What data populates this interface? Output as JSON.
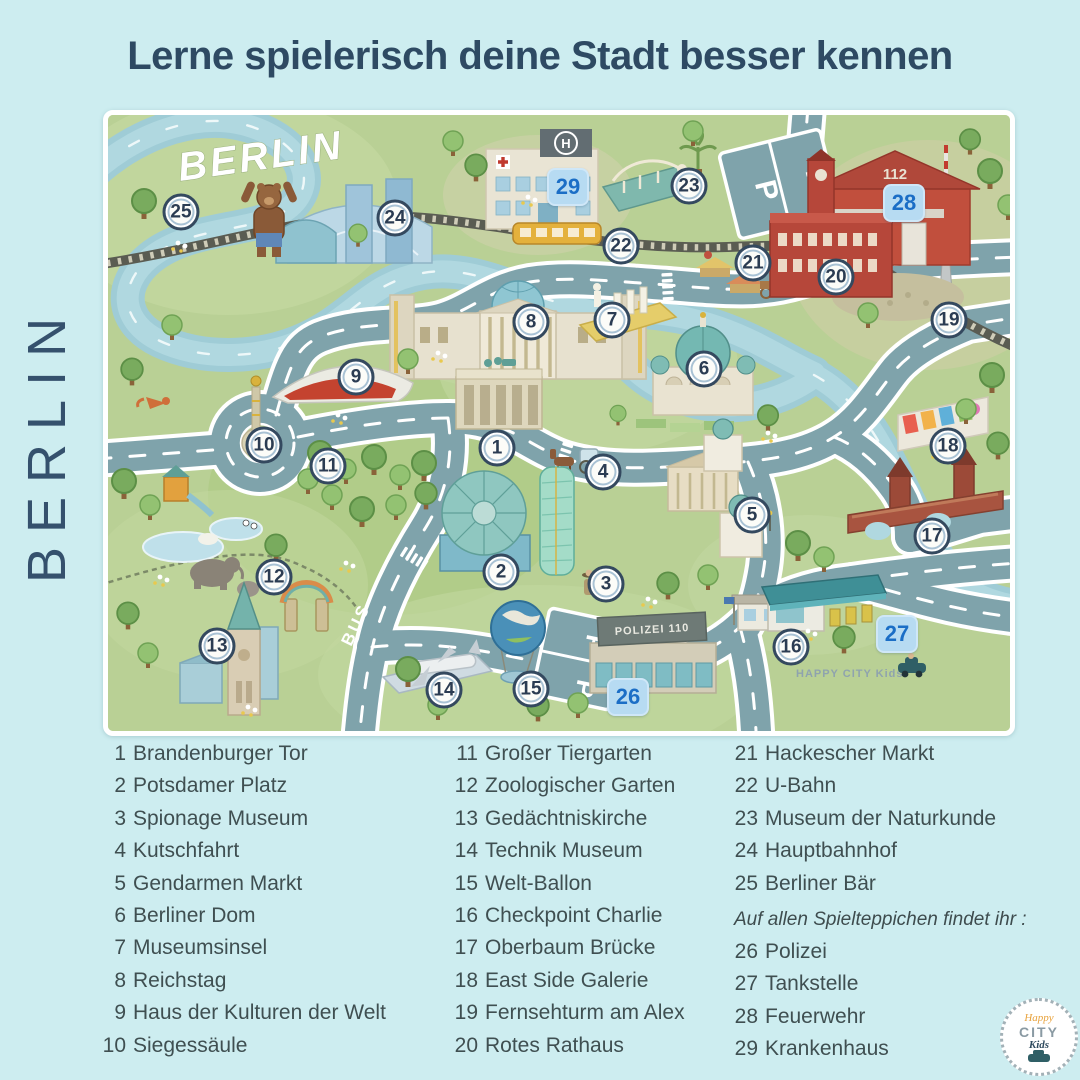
{
  "title": "Lerne spielerisch deine Stadt besser kennen",
  "vertical_label": "BERLIN",
  "map": {
    "label": "BERLIN",
    "bus_lane_label": "BUS",
    "parking_label": "P",
    "hospital_roof_label": "H",
    "fire_station_number": "112",
    "police_roof_label": "POLIZEI 110",
    "watermark": "HAPPY CITY Kids",
    "markers": [
      {
        "n": "1",
        "x": 389,
        "y": 333,
        "type": "circle"
      },
      {
        "n": "2",
        "x": 393,
        "y": 457,
        "type": "circle"
      },
      {
        "n": "3",
        "x": 498,
        "y": 469,
        "type": "circle"
      },
      {
        "n": "4",
        "x": 495,
        "y": 357,
        "type": "circle"
      },
      {
        "n": "5",
        "x": 644,
        "y": 400,
        "type": "circle"
      },
      {
        "n": "6",
        "x": 596,
        "y": 254,
        "type": "circle"
      },
      {
        "n": "7",
        "x": 504,
        "y": 205,
        "type": "circle"
      },
      {
        "n": "8",
        "x": 423,
        "y": 207,
        "type": "circle"
      },
      {
        "n": "9",
        "x": 248,
        "y": 262,
        "type": "circle"
      },
      {
        "n": "10",
        "x": 156,
        "y": 330,
        "type": "circle"
      },
      {
        "n": "11",
        "x": 220,
        "y": 351,
        "type": "circle"
      },
      {
        "n": "12",
        "x": 166,
        "y": 462,
        "type": "circle"
      },
      {
        "n": "13",
        "x": 109,
        "y": 531,
        "type": "circle"
      },
      {
        "n": "14",
        "x": 336,
        "y": 575,
        "type": "circle"
      },
      {
        "n": "15",
        "x": 423,
        "y": 574,
        "type": "circle"
      },
      {
        "n": "16",
        "x": 683,
        "y": 532,
        "type": "circle"
      },
      {
        "n": "17",
        "x": 824,
        "y": 421,
        "type": "circle"
      },
      {
        "n": "18",
        "x": 840,
        "y": 331,
        "type": "circle"
      },
      {
        "n": "19",
        "x": 841,
        "y": 205,
        "type": "circle"
      },
      {
        "n": "20",
        "x": 728,
        "y": 162,
        "type": "circle"
      },
      {
        "n": "21",
        "x": 645,
        "y": 148,
        "type": "circle"
      },
      {
        "n": "22",
        "x": 513,
        "y": 131,
        "type": "circle"
      },
      {
        "n": "23",
        "x": 581,
        "y": 71,
        "type": "circle"
      },
      {
        "n": "24",
        "x": 287,
        "y": 103,
        "type": "circle"
      },
      {
        "n": "25",
        "x": 73,
        "y": 97,
        "type": "circle"
      },
      {
        "n": "26",
        "x": 520,
        "y": 582,
        "type": "badge"
      },
      {
        "n": "27",
        "x": 789,
        "y": 519,
        "type": "badge"
      },
      {
        "n": "28",
        "x": 796,
        "y": 88,
        "type": "badge"
      },
      {
        "n": "29",
        "x": 460,
        "y": 72,
        "type": "badge"
      }
    ]
  },
  "legend": {
    "columns": [
      {
        "items": [
          {
            "n": "1",
            "label": "Brandenburger Tor"
          },
          {
            "n": "2",
            "label": "Potsdamer Platz"
          },
          {
            "n": "3",
            "label": "Spionage Museum"
          },
          {
            "n": "4",
            "label": "Kutschfahrt"
          },
          {
            "n": "5",
            "label": "Gendarmen Markt"
          },
          {
            "n": "6",
            "label": "Berliner Dom"
          },
          {
            "n": "7",
            "label": "Museumsinsel"
          },
          {
            "n": "8",
            "label": "Reichstag"
          },
          {
            "n": "9",
            "label": "Haus der Kulturen der Welt"
          },
          {
            "n": "10",
            "label": "Siegessäule"
          }
        ]
      },
      {
        "items": [
          {
            "n": "11",
            "label": "Großer Tiergarten"
          },
          {
            "n": "12",
            "label": "Zoologischer Garten"
          },
          {
            "n": "13",
            "label": "Gedächtniskirche"
          },
          {
            "n": "14",
            "label": "Technik Museum"
          },
          {
            "n": "15",
            "label": "Welt-Ballon"
          },
          {
            "n": "16",
            "label": "Checkpoint Charlie"
          },
          {
            "n": "17",
            "label": "Oberbaum Brücke"
          },
          {
            "n": "18",
            "label": "East Side Galerie"
          },
          {
            "n": "19",
            "label": "Fernsehturm am Alex"
          },
          {
            "n": "20",
            "label": "Rotes Rathaus"
          }
        ]
      },
      {
        "items": [
          {
            "n": "21",
            "label": "Hackescher Markt"
          },
          {
            "n": "22",
            "label": "U-Bahn"
          },
          {
            "n": "23",
            "label": "Museum der Naturkunde"
          },
          {
            "n": "24",
            "label": "Hauptbahnhof"
          },
          {
            "n": "25",
            "label": "Berliner Bär"
          }
        ],
        "note": "Auf allen Spielteppichen findet ihr :",
        "items_after": [
          {
            "n": "26",
            "label": "Polizei"
          },
          {
            "n": "27",
            "label": "Tankstelle"
          },
          {
            "n": "28",
            "label": "Feuerwehr"
          },
          {
            "n": "29",
            "label": "Krankenhaus"
          }
        ]
      }
    ]
  },
  "logo": {
    "line1": "Happy",
    "line2": "CITY",
    "line3": "Kids"
  },
  "colors": {
    "background": "#cdedf0",
    "title": "#2e4a63",
    "road": "#7fa3ab",
    "river": "#9fccd6",
    "grass": "#b9d095",
    "marker_ring": "#34495f",
    "badge_text": "#1b6ec6"
  }
}
